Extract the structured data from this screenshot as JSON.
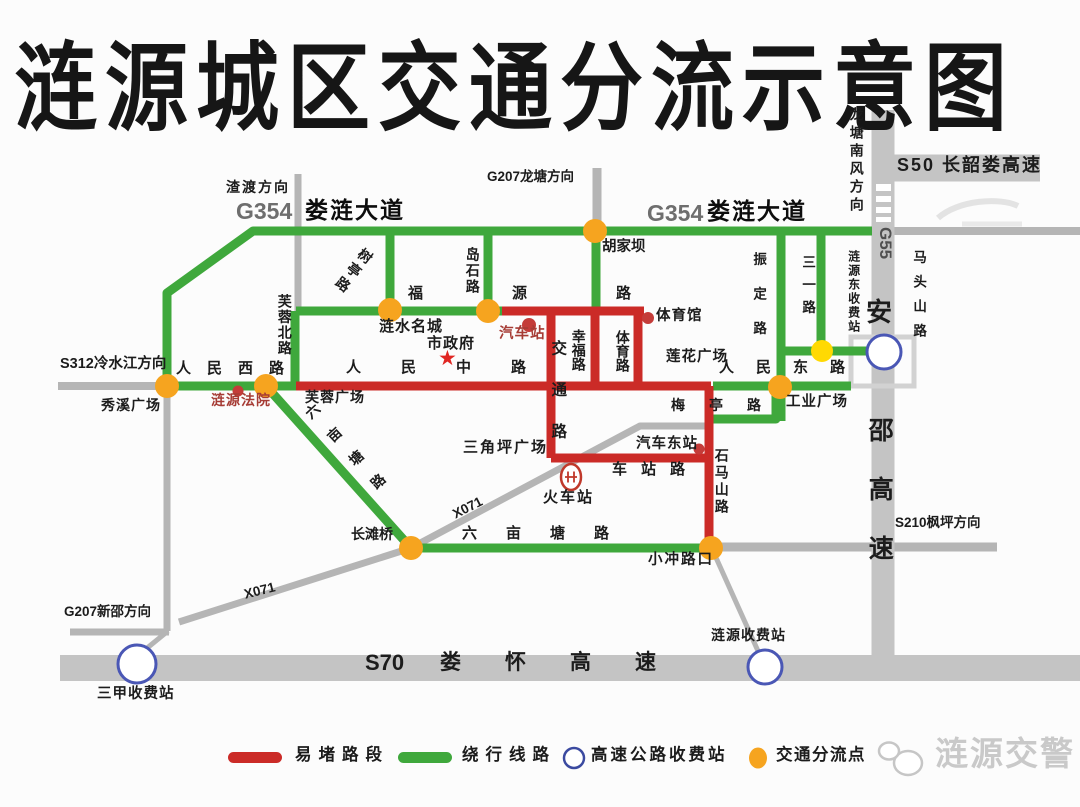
{
  "title": "涟源城区交通分流示意图",
  "colors": {
    "congested_red": "#cb2b27",
    "detour_green": "#3fa83c",
    "highway_gray": "#c4c4c4",
    "road_gray": "#b5b5b5",
    "divert_point_orange": "#f6a41f",
    "divert_point_yellow": "#ffd903",
    "toll_ring_blue": "#4a57b5",
    "poi_red": "#c43c39",
    "watermark_gray": "#c9c9c9"
  },
  "labels": {
    "zhadu": "渣渡方向",
    "g354_left": "G354",
    "loulian_left": "娄涟大道",
    "g207_longtang": "G207龙塘方向",
    "g354_right": "G354",
    "loulian_right": "娄涟大道",
    "longtang_nanfeng": "龙塘南风方向",
    "s50": "S50 长韶娄高速",
    "g55": "G55",
    "an": "安",
    "shaogaosu": "邵高速",
    "matoushan": "马头山路",
    "lianyuandong_toll": "涟源东收费站",
    "sanyi_road": "三一路",
    "zhending_road": "振定路",
    "hujiaba": "胡家坝",
    "shuting_road": "树亭路",
    "daoshi_road": "岛石路",
    "fuyuan_road": "福源路",
    "qichezhan": "汽车站",
    "lianshui_mingcheng": "涟水名城",
    "shizhengfu": "市政府",
    "xingfu_road": "幸福路",
    "tiyu_road": "体育路",
    "tiyuguan": "体育馆",
    "lianhua_square": "莲花广场",
    "s312": "S312冷水江方向",
    "renmin_xi": "人民西路",
    "xiuxi_square": "秀溪广场",
    "lianyuan_court": "涟源法院",
    "furong_bei": "芙蓉北路",
    "furong_square": "芙蓉广场",
    "renmin_zhong": "人民中路",
    "jiaotong_road": "交通路",
    "renmin_dong": "人民东路",
    "gongye_square": "工业广场",
    "meiting_road": "梅亭路",
    "qiche_dongzhan": "汽车东站",
    "shimashan_road": "石马山路",
    "sanjiaoping_square": "三角坪广场",
    "chezhan_road": "车站路",
    "huochezhan": "火车站",
    "liumutang_diag": "六亩塘路",
    "liumutang_horiz": "六亩塘路",
    "changtanqiao": "长滩桥",
    "xiaochong": "小冲路口",
    "x071_sw": "X071",
    "x071_ne": "X071",
    "s210": "S210枫坪方向",
    "g207_xinshao": "G207新邵方向",
    "sanjia_toll": "三甲收费站",
    "lianyuan_toll": "涟源收费站",
    "s70": "S70",
    "louhuai": "娄怀高速"
  },
  "icons": {
    "star": "★"
  },
  "legend": {
    "congested": "易堵路段",
    "detour": "绕行线路",
    "toll": "高速公路收费站",
    "divert": "交通分流点"
  },
  "watermark": {
    "brand": "涟源交警"
  }
}
